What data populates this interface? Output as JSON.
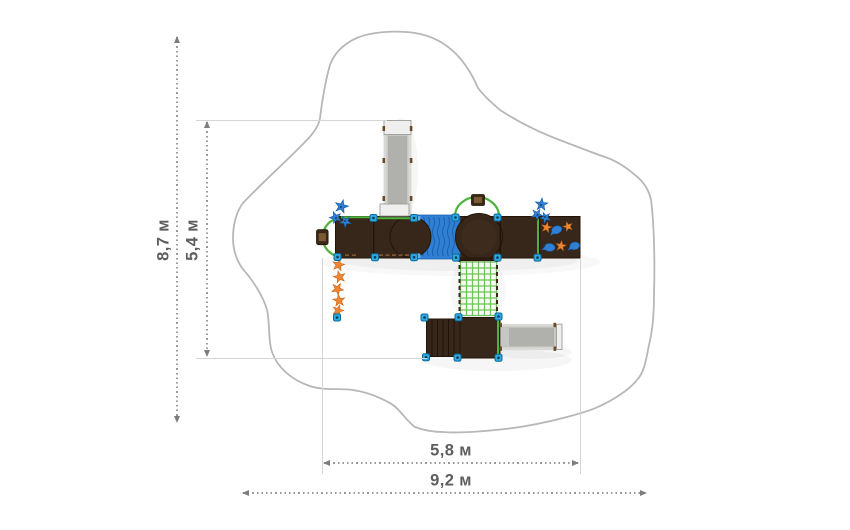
{
  "dimension_labels": {
    "site_height": "8,7 м",
    "equipment_height": "5,4 м",
    "equipment_width": "5,8 м",
    "site_width": "9,2 м"
  },
  "palette": {
    "background": "#ffffff",
    "dimension_line": "#9a9a9a",
    "dimension_arrow": "#7d7d7d",
    "dimension_text": "#5e5e5e",
    "extension_line": "#d5d5d5",
    "safety_zone_outline": "#b7b7b7",
    "platform_brown": "#37271a",
    "platform_edge": "#221406",
    "accent_blue": "#2f80d4",
    "wave_blue": "#1c5ea8",
    "post_blue": "#2fa9e1",
    "rail_green": "#4eb33c",
    "net_line_green": "#63bb4e",
    "star_orange": "#ef8636",
    "wood_tan": "#8a6038",
    "slide_surface": "#b0b0ac",
    "slide_rail": "#d9d9d6"
  }
}
